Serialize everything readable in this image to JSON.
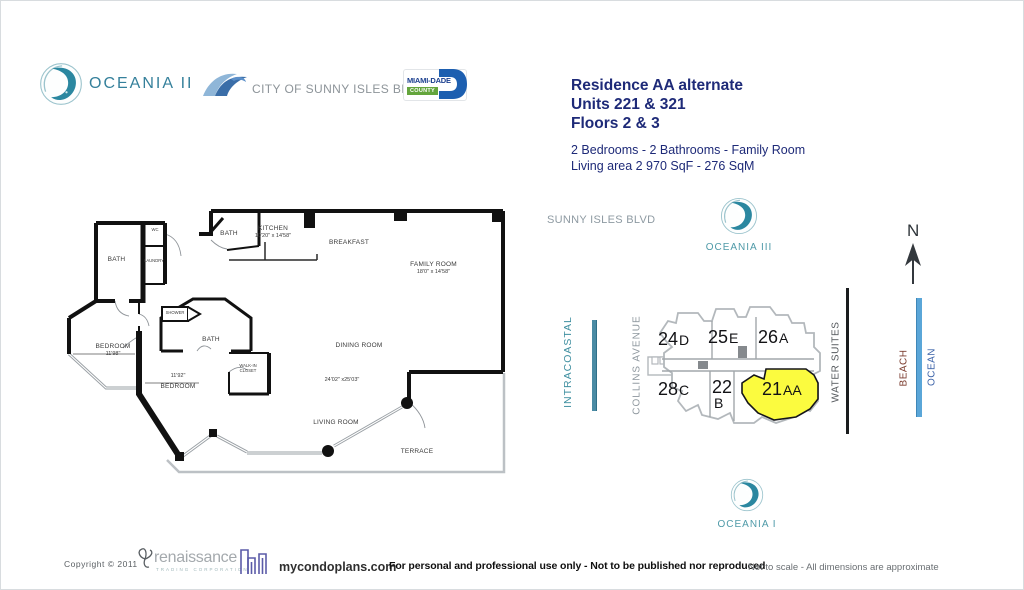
{
  "header": {
    "brand": "OCEANIA II",
    "city": "CITY OF SUNNY ISLES BEACH",
    "county_line1": "MIAMI-DADE",
    "county_line2": "COUNTY",
    "title_line1": "Residence AA alternate",
    "title_line2": "Units 221 & 321",
    "title_line3": "Floors 2 & 3",
    "subtitle_line1": "2 Bedrooms - 2 Bathrooms - Family Room",
    "subtitle_line2": "Living area  2 970 SqF - 276 SqM"
  },
  "floorplan": {
    "rooms": {
      "bath_left": {
        "name": "BATH"
      },
      "wc": {
        "name": "WC"
      },
      "laundry": {
        "name": "LAUNDRY"
      },
      "bath_top": {
        "name": "BATH"
      },
      "kitchen": {
        "name": "KITCHEN",
        "dim": "10'20\" x 14'58\""
      },
      "breakfast": {
        "name": "BREAKFAST"
      },
      "family": {
        "name": "FAMILY ROOM",
        "dim": "18'0\" x 14'58\""
      },
      "shower": {
        "name": "SHOWER"
      },
      "bath_center": {
        "name": "BATH"
      },
      "dining": {
        "name": "DINING ROOM"
      },
      "bedroom_left": {
        "name": "BEDROOM",
        "dim": "11'98\""
      },
      "bedroom_center": {
        "name": "BEDROOM",
        "dim": "11'92\""
      },
      "walkin": {
        "line1": "WALK-IN",
        "line2": "CLOSET"
      },
      "living": {
        "name": "LIVING ROOM",
        "dim": "24'02\" x25'03\""
      },
      "terrace": {
        "name": "TERRACE"
      }
    }
  },
  "siteplan": {
    "street": "SUNNY ISLES BLVD",
    "avenue": "COLLINS AVENUE",
    "water_suites": "WATER SUITES",
    "intracoastal": "INTRACOASTAL",
    "beach": "BEACH",
    "ocean": "OCEAN",
    "north": "N",
    "oceania3": "OCEANIA III",
    "oceania1": "OCEANIA I",
    "units": [
      {
        "number": "24",
        "letter": "D"
      },
      {
        "number": "25",
        "letter": "E"
      },
      {
        "number": "26",
        "letter": "A"
      },
      {
        "number": "28",
        "letter": "C"
      },
      {
        "number": "22",
        "letter": "B"
      },
      {
        "number": "21",
        "letter": "AA",
        "highlighted": true
      }
    ]
  },
  "footer": {
    "copyright": "Copyright  ©   2011",
    "renaissance": "renaissance",
    "renaissance_sub": "TRADING CORPORATION",
    "condoplans": "mycondoplans.com",
    "disclaimer_main": "For personal and professional use only - Not to be published nor reproduced",
    "disclaimer_right": "Not to scale - All dimensions are approximate"
  },
  "colors": {
    "accent_navy": "#1e2a78",
    "brand_teal": "#35809b",
    "highlight_yellow": "#fbfb3f",
    "beach_text": "#7a3a2c",
    "ocean_text": "#3b62a8",
    "intracoastal_text": "#3f8fa0"
  }
}
